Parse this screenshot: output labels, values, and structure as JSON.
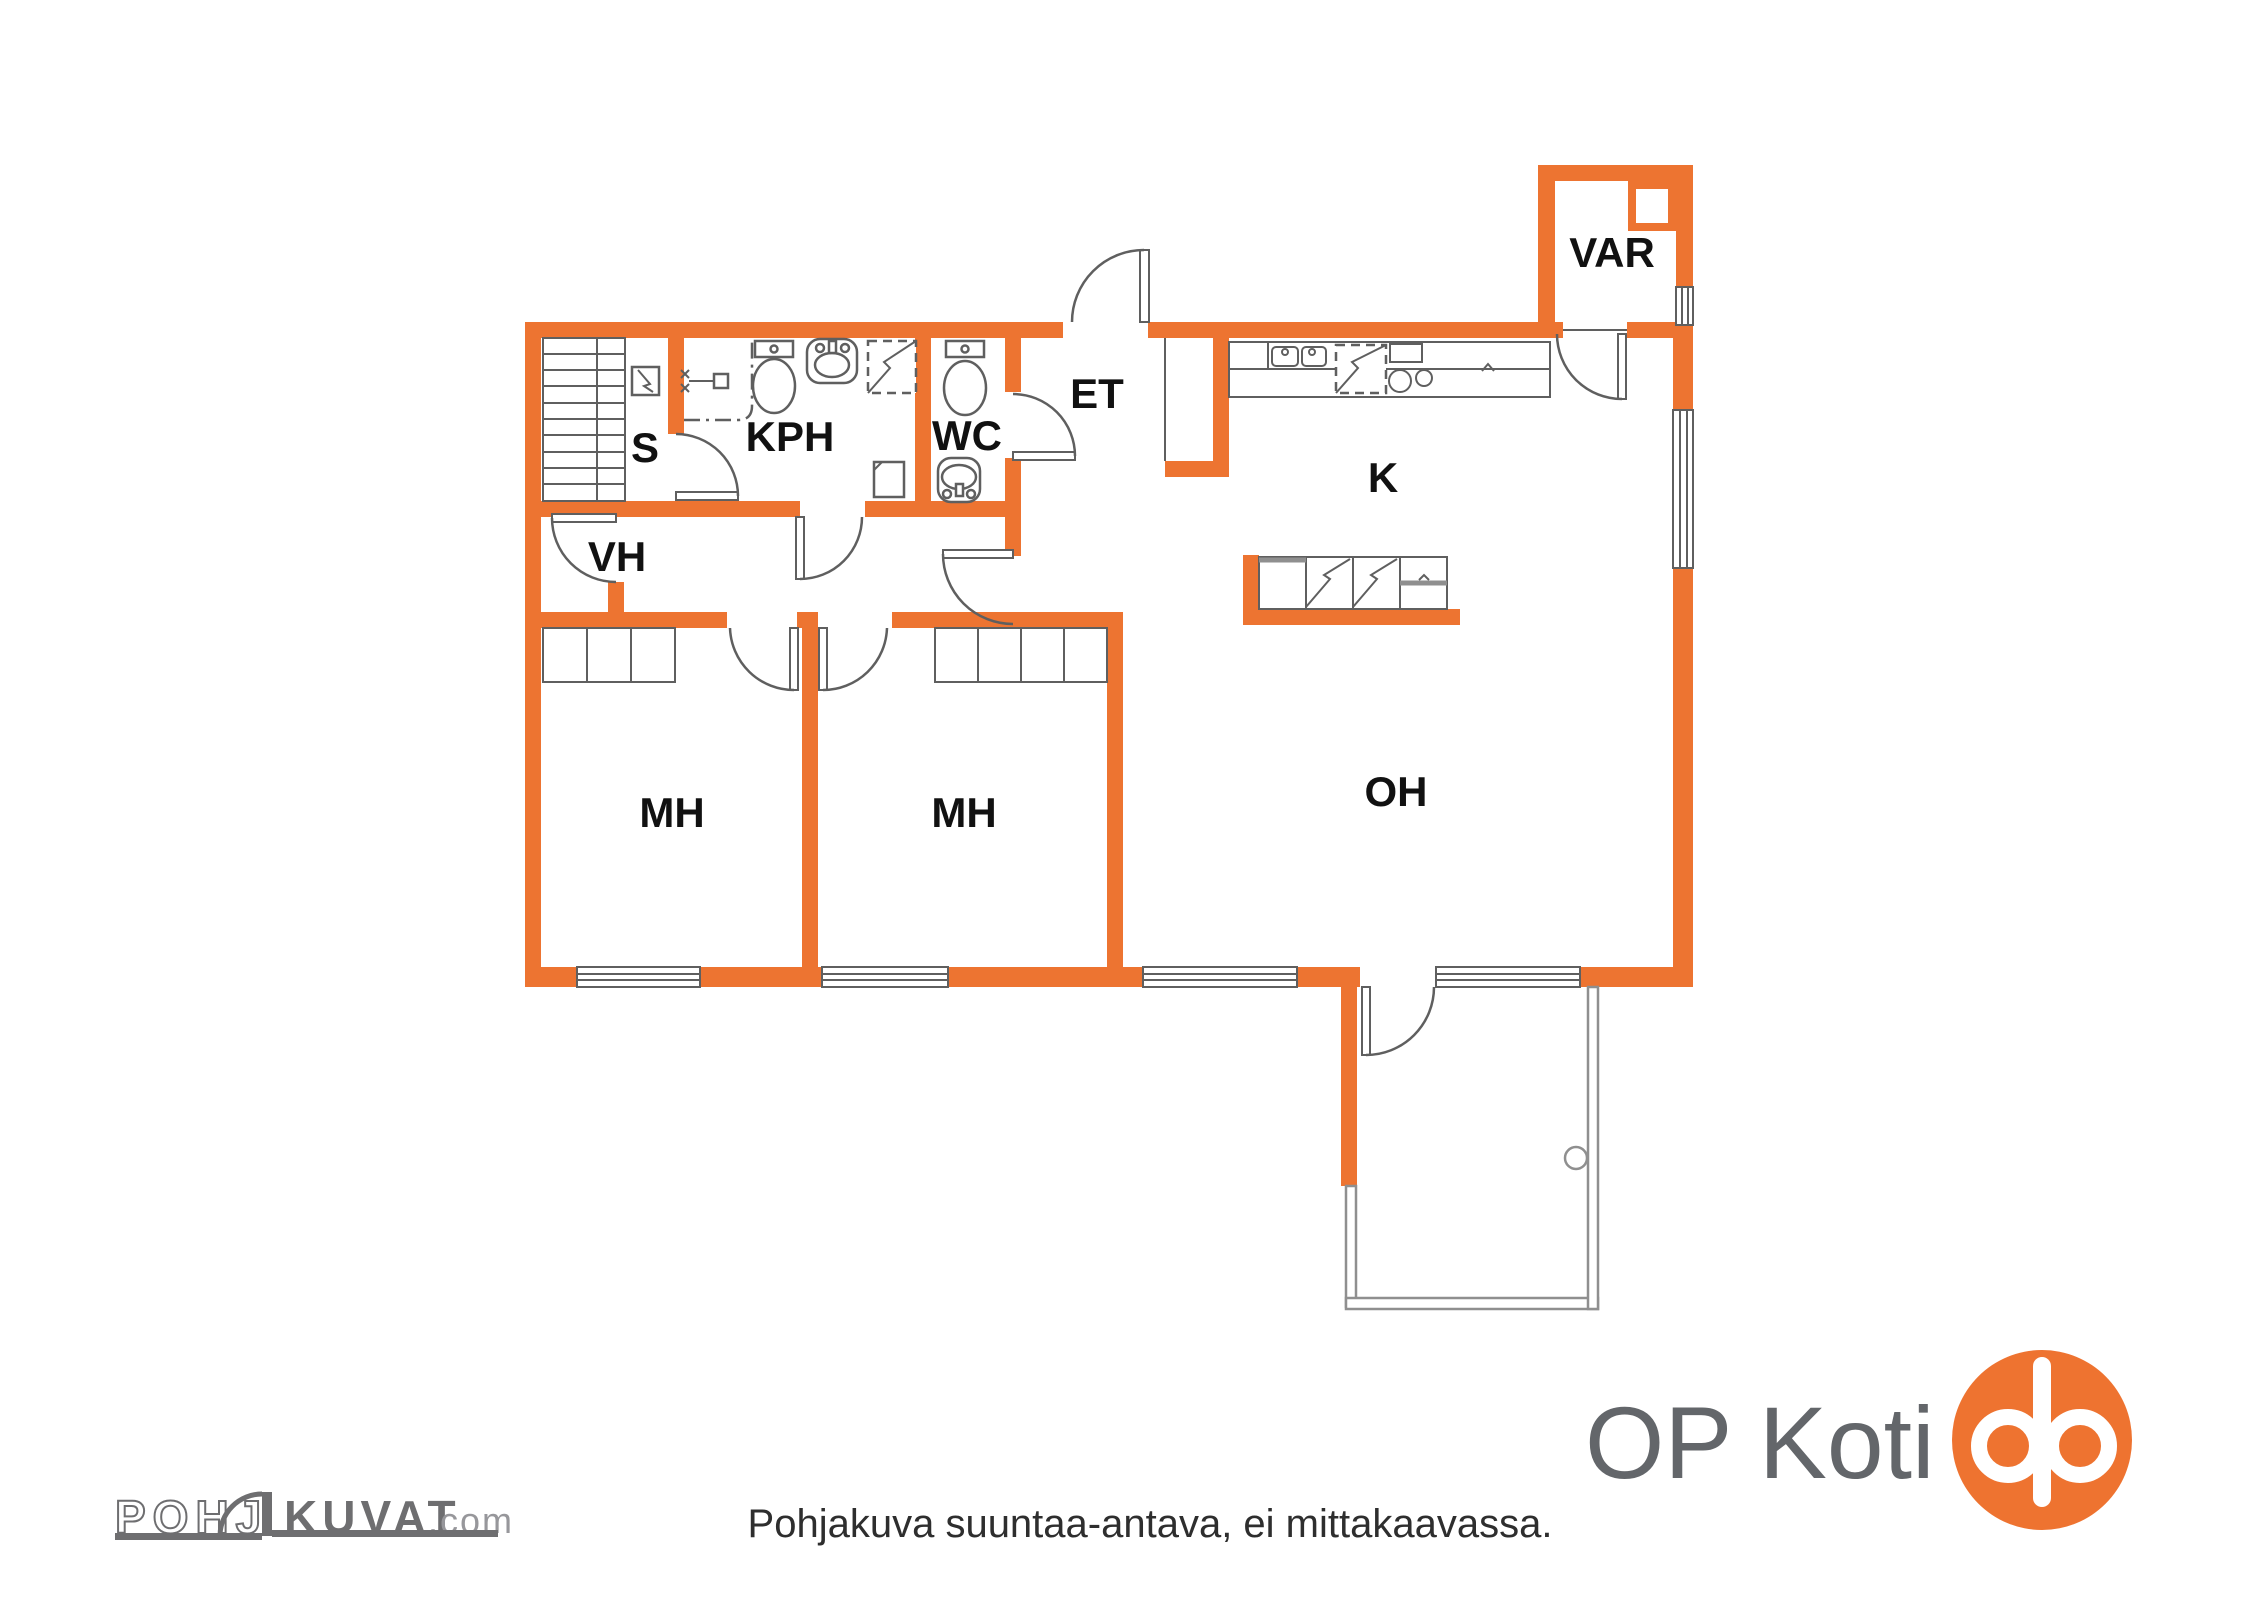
{
  "colors": {
    "wall": "#ED7431",
    "line": "#5f5f5f",
    "line-light": "#8f8f8f",
    "label": "#111111",
    "disclaimer": "#2e2e2e",
    "logo-gray": "#6E6E70",
    "logo-light": "#97979B",
    "op-gray": "#63666A",
    "op-orange": "#EE7330"
  },
  "rooms": {
    "sauna": "S",
    "bathroom": "KPH",
    "toilet": "WC",
    "entry": "ET",
    "walk_in_closet": "VH",
    "bedroom1": "MH",
    "bedroom2": "MH",
    "kitchen": "K",
    "living_room": "OH",
    "storage": "VAR"
  },
  "footer": {
    "disclaimer": "Pohjakuva suuntaa-antava, ei mittakaavassa."
  },
  "logos": {
    "pohjakuvat": {
      "outline": "POHJ",
      "solid": "KUVAT",
      "tld": ".com"
    },
    "op": {
      "wordmark": "OP Koti"
    }
  }
}
